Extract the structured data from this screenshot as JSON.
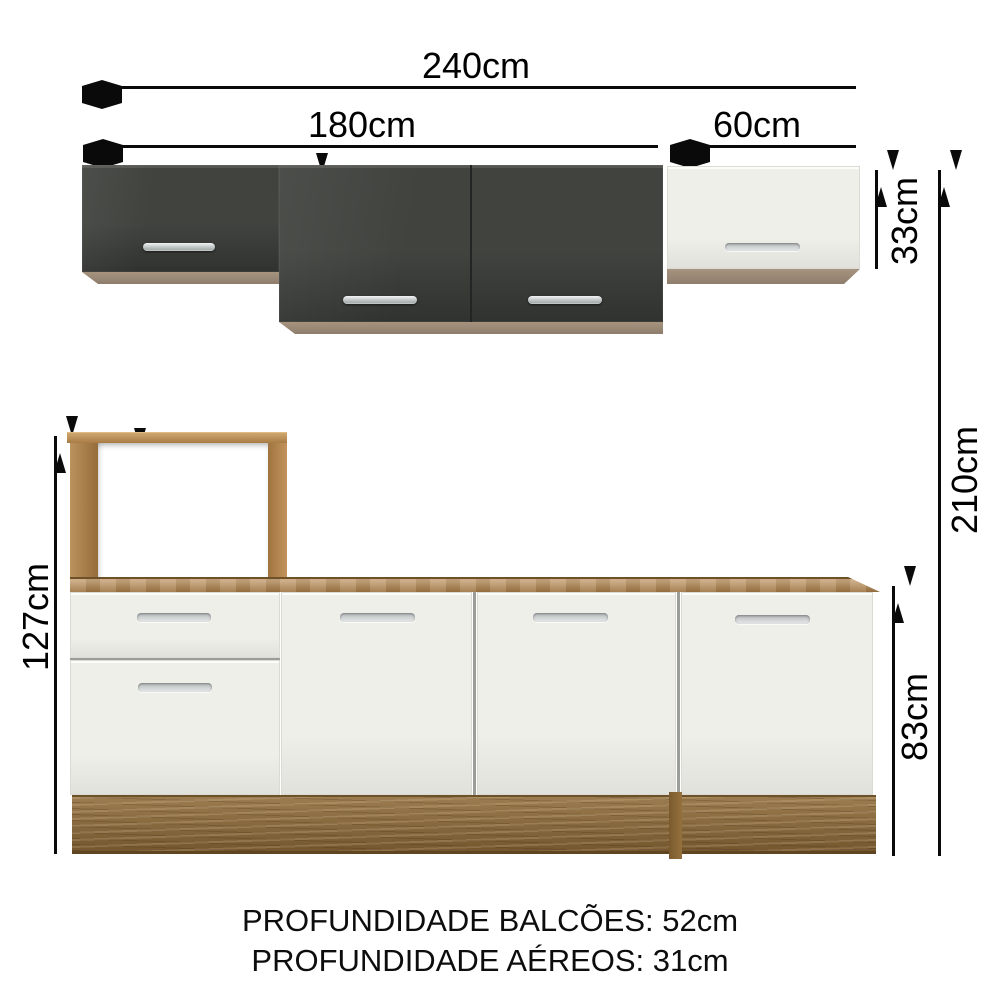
{
  "dimensions": {
    "total_width": "240cm",
    "upper_dark_section_width": "180cm",
    "upper_white_cabinet_width": "60cm",
    "upper_center_cabinet_height": "49cm",
    "upper_white_cabinet_height": "33cm",
    "total_height": "210cm",
    "left_tower_height": "127cm",
    "niche_height": "45cm",
    "base_cabinet_height": "83cm"
  },
  "footer_notes": {
    "counter_depth": "PROFUNDIDADE BALCÕES: 52cm",
    "wall_cabinet_depth": "PROFUNDIDADE AÉREOS: 31cm"
  },
  "colors": {
    "dark_cabinet": "#41433f",
    "white_cabinet": "#efefea",
    "wood_counter": "#b2834a",
    "wood_base": "#8e6a38",
    "wood_frame": "#b08550",
    "cabinet_underside": "#9d8c7d",
    "handle_metal": "#c9cdce",
    "dimension_line": "#0a0a0a",
    "background": "#ffffff"
  }
}
